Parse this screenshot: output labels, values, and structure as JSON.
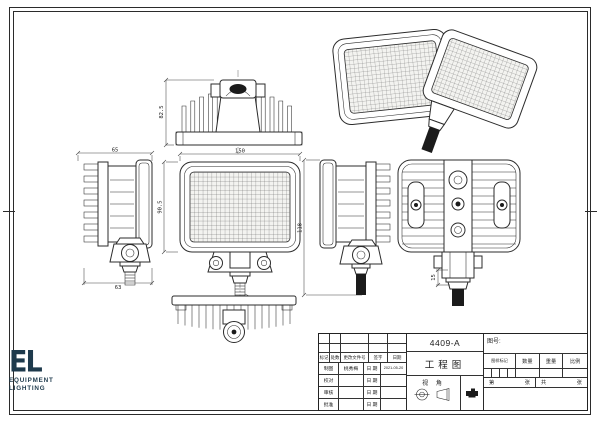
{
  "sheet": {
    "background": "#ffffff",
    "line_color": "#2b2b2b"
  },
  "logo": {
    "monogram": "EL",
    "line1": "EQUIPMENT",
    "line2": "LIGHTING",
    "color": "#1e3a4c"
  },
  "title_block": {
    "part_number": "4409-A",
    "doc_type": "工程图",
    "drawing_no_label": "图号:",
    "view_angle_label": "视 角",
    "rev_header": [
      "标记",
      "处数",
      "更改文件号",
      "签字",
      "日期"
    ],
    "sign_rows": [
      {
        "role": "制图",
        "name": "桃秀梅",
        "date_label": "日 期",
        "date": "2021-05-20"
      },
      {
        "role": "校对",
        "name": "",
        "date_label": "日 期",
        "date": ""
      },
      {
        "role": "审核",
        "name": "",
        "date_label": "日 期",
        "date": ""
      },
      {
        "role": "批准",
        "name": "",
        "date_label": "日 期",
        "date": ""
      }
    ],
    "info_labels": [
      "图样标记",
      "数量",
      "重量",
      "比例"
    ],
    "sheet_labels": [
      "第",
      "张",
      "共",
      "张"
    ]
  },
  "dimensions": {
    "top_view_height": "82.5",
    "side_view_width": "65",
    "side_view_base": "63",
    "front_width": "150",
    "front_height": "90.5",
    "overall_height": "118",
    "thread_spec": "M10",
    "stud_length": "15"
  }
}
